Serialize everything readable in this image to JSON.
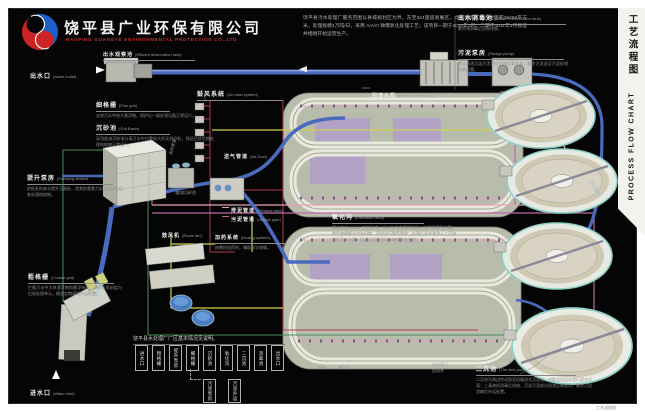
{
  "header": {
    "company_cn": "饶平县广业环保有限公司",
    "company_en": "RAOPING GUANGYE ENVIRONMENTAL PROTECTION CO.,LTD",
    "intro": "饶平县污水处理厂服务范围以县城规划区为界，东至324国道发展区，北至旧城区；占地面积39400平方米，处理规模4万吨/日，采用 A/A/O 微曝氧化处理工艺；该项目一期于2010年3月、二期于2011年4月投建并相继开始运营生产。"
  },
  "title_strip": {
    "cn": "工艺流程图",
    "en": "PROCESS FLOW CHART"
  },
  "border_caption": "工艺流程图",
  "labels": {
    "effluent_observation": {
      "cn": "出水观察池",
      "en": "(Effluent observation tank)"
    },
    "water_outlet": {
      "cn": "出水口",
      "en": "(water outlet)"
    },
    "fine_grid": {
      "cn": "细格栅",
      "en": "(Fine grid)",
      "desc": "去除污水中较大悬浮物，保护后一级处理设备正常运行。"
    },
    "grit_basin": {
      "cn": "沉砂池",
      "en": "(Grit Basin)",
      "desc": "采用旋流沉砂池分离污水中比重较大的无机砂粒，保证后续生物处理构筑物正常运行。"
    },
    "pumping_station": {
      "cn": "提升泵房",
      "en": "(Pumping station)",
      "desc": "把低处的来水提升至高处，使其依靠重力自流通过后续各处理构筑物。"
    },
    "air_blast_system": {
      "cn": "鼓风系统",
      "en": "(Air blast system)"
    },
    "air_duct": {
      "cn": "送气管道",
      "en": "(Air Duct)"
    },
    "sewage_pipe": {
      "cn": "排泥管道",
      "en": "(Sewage pipe)"
    },
    "sludge_pipe": {
      "cn": "污泥管道",
      "en": "(Sludge pipe)"
    },
    "oxidation_ditch": {
      "cn": "氧化沟",
      "en": "(Oxidation ditch)",
      "desc": "氧化沟为 A/A/O 工艺形式，污水在沟内循环流动，由转刷曝气充氧，微生物降解水中有机物，同时进行脱氮除磷；处理后混合液流入二沉池进行泥水分离，回流污泥返回沟内继续参与反应。"
    },
    "roots_fan": {
      "cn": "鼓风机",
      "en": "(Roots fan)"
    },
    "dosing_system": {
      "cn": "加药系统",
      "en": "(Dosing system)",
      "desc": "按需投加药剂，辅助化学除磷。"
    },
    "coarse_grid": {
      "cn": "粗格栅",
      "en": "(Coarse grid)",
      "desc": "拦截污水中大块漂浮物和悬浮杂质，保护水泵机组与后续处理单元，栅渣定期清理外运处置。"
    },
    "water_inlet": {
      "cn": "进水口",
      "en": "(Water inlet)"
    },
    "return_water_pump": {
      "cn": "回流水泵",
      "en": "(Return water pump)"
    },
    "effluent_disinfection": {
      "cn": "出水消毒池",
      "en": "(Effluent disinfection tank)",
      "desc": "紫外线消毒后达标排放。"
    },
    "sludge_pump": {
      "cn": "污泥泵房",
      "en": "(Sludge pump)",
      "desc": "将二沉池沉淀污泥部分回流至氧化沟，剩余污泥送至污泥处理系统处置。"
    },
    "secondary_clarifier": {
      "cn": "二沉池",
      "en": "(The sink pool)",
      "desc": "二沉池为周边传动刮泥机辐流式沉淀池，对氧化沟出水进行泥水分离；上清液经消毒后排放，沉淀污泥部分回流至氧化沟，剩余污泥浓缩后外运处置。"
    },
    "return_pipe": {
      "cn": "回流管道"
    },
    "inlet_pipe": {
      "cn": "进水管道"
    },
    "vortex_grit": {
      "cn": "旋流沉砂池"
    },
    "air_supply_pipe": {
      "cn": "送风管道"
    },
    "rotating_brush": {
      "cn": "转刷"
    },
    "aerator": {
      "cn": "曝气机"
    },
    "outlet_weir": {
      "cn": "出水堰门"
    },
    "return_well": {
      "cn": "回流井"
    }
  },
  "mini_flow": {
    "caption": "饶平县水处理厂厂区基本情况见说明。",
    "main": [
      "进水口",
      "粗格栅",
      "提升泵房",
      "细格栅",
      "沉砂池",
      "氧化沟",
      "二沉池",
      "消毒池",
      "出水口"
    ],
    "branch": [
      "污泥泵房",
      "污泥外运"
    ]
  },
  "colors": {
    "accent_red": "#c03030",
    "pipe_blue": "#4a6abe",
    "pipe_blue_light": "#93aade",
    "pipe_cyan": "#79b7d6",
    "pipe_magenta": "#bb6aa2",
    "pipe_pink": "#e2a4ba",
    "pipe_yellow": "#cfd051",
    "pipe_green": "#4d8a5c",
    "pipe_red": "#b23a4e",
    "clarifier_rim": "#8fd0c6",
    "lavender": "#b2a3c6"
  }
}
